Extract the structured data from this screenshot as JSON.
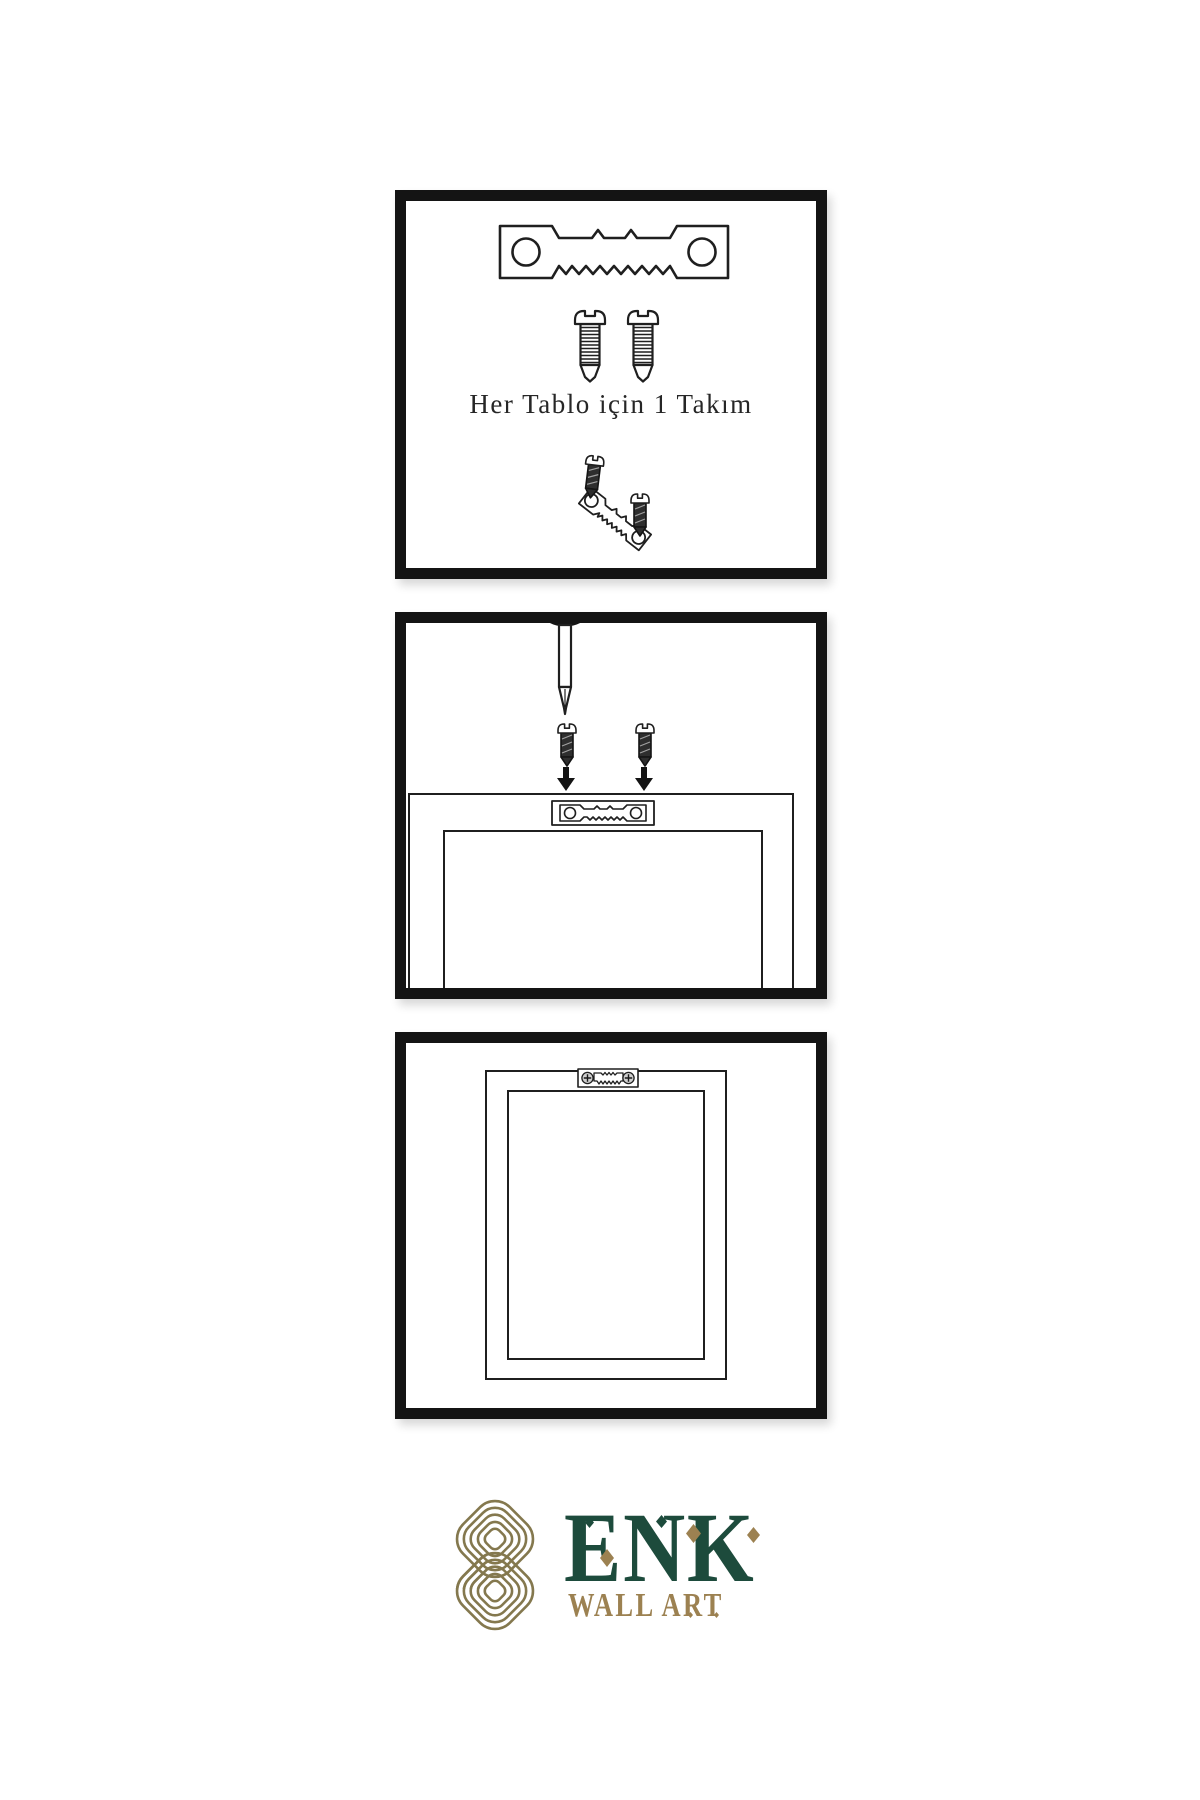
{
  "colors": {
    "outline": "#1f1f1f",
    "panel-border": "#141414",
    "screw-dark": "#2e2e2e",
    "logo-green": "#1d4b3c",
    "logo-gold": "#9c8151",
    "knot-gold": "#84784e"
  },
  "steps": [
    {
      "name": "hardware-kit",
      "caption": "Her Tablo için 1 Takım",
      "icons": [
        "sawtooth-hanger-icon",
        "screw-icon",
        "screw-icon",
        "screw-icon",
        "angled-sawtooth-hanger-icon"
      ]
    },
    {
      "name": "attach-hanger-to-frame-back",
      "icons": [
        "nail-icon",
        "screw-icon",
        "screw-icon",
        "arrow-down-icon",
        "arrow-down-icon",
        "sawtooth-hanger-icon",
        "frame-back-icon"
      ]
    },
    {
      "name": "frame-hung-on-wall",
      "icons": [
        "sawtooth-hanger-with-screws-icon",
        "frame-front-icon"
      ]
    }
  ],
  "logo": {
    "brand": "ENK",
    "subtitle": "WALL ART",
    "icons": [
      "knot-icon",
      "diamond-ornament"
    ]
  }
}
